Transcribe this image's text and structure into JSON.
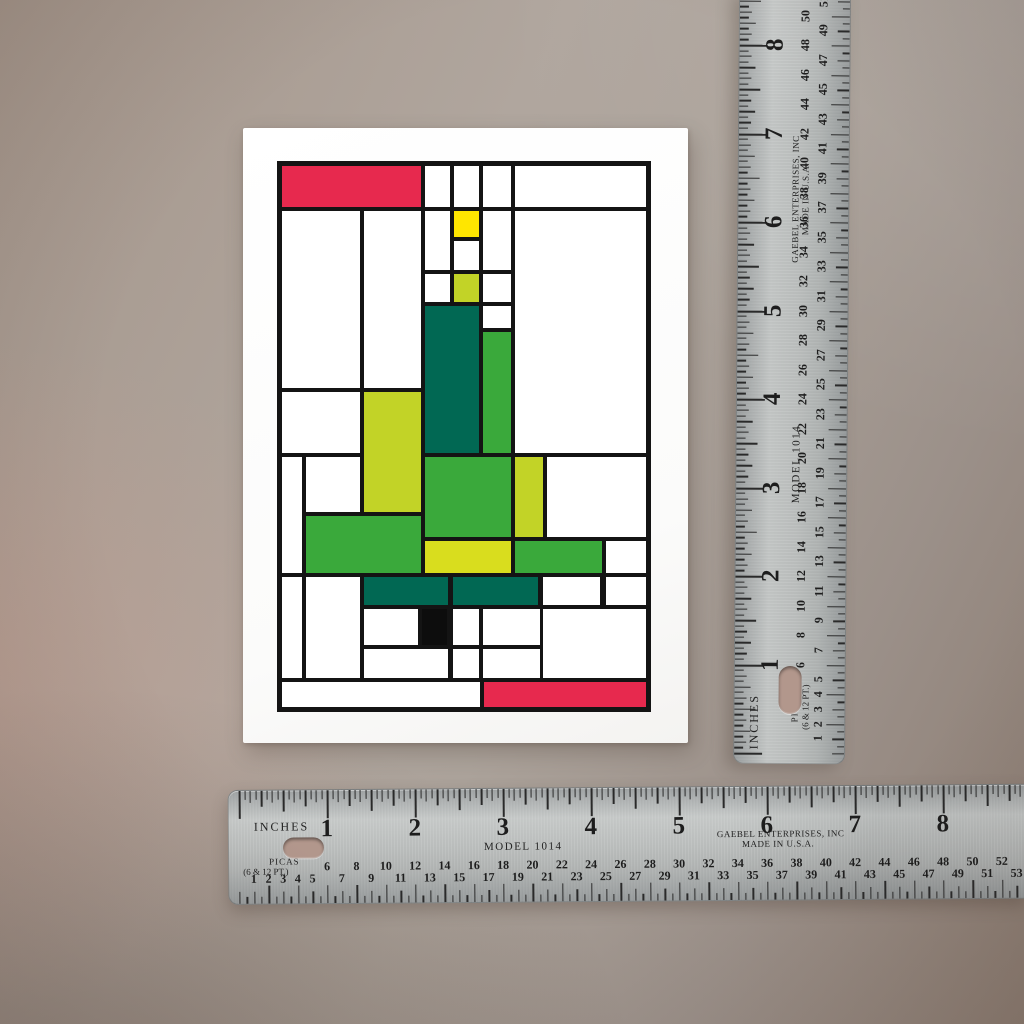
{
  "card": {
    "greeting": {
      "line1": "Merry",
      "line2": "Christmas",
      "color": "#0f0f0f"
    },
    "design": {
      "line_color": "#141414",
      "palette": {
        "red": "#e7294e",
        "yellow": "#ffe600",
        "chartreuse": "#c2d327",
        "yellowgreen": "#d9dd1e",
        "green": "#3aa93b",
        "teal": "#016853",
        "black": "#0d0d0d",
        "white": "#ffffff"
      },
      "cells": [
        {
          "x": 5,
          "y": 5,
          "w": 139,
          "h": 41,
          "c": "red"
        },
        {
          "x": 148,
          "y": 5,
          "w": 25,
          "h": 41,
          "c": "white"
        },
        {
          "x": 177,
          "y": 5,
          "w": 25,
          "h": 41,
          "c": "white"
        },
        {
          "x": 206,
          "y": 5,
          "w": 28,
          "h": 41,
          "c": "white"
        },
        {
          "x": 238,
          "y": 5,
          "w": 131,
          "h": 41,
          "c": "white"
        },
        {
          "x": 5,
          "y": 50,
          "w": 78,
          "h": 177,
          "c": "white"
        },
        {
          "x": 87,
          "y": 50,
          "w": 57,
          "h": 177,
          "c": "white"
        },
        {
          "x": 148,
          "y": 50,
          "w": 25,
          "h": 59,
          "c": "white"
        },
        {
          "x": 177,
          "y": 50,
          "w": 25,
          "h": 26,
          "c": "yellow"
        },
        {
          "x": 177,
          "y": 80,
          "w": 25,
          "h": 29,
          "c": "white"
        },
        {
          "x": 206,
          "y": 50,
          "w": 28,
          "h": 59,
          "c": "white"
        },
        {
          "x": 148,
          "y": 113,
          "w": 25,
          "h": 28,
          "c": "white"
        },
        {
          "x": 177,
          "y": 113,
          "w": 25,
          "h": 28,
          "c": "chartreuse"
        },
        {
          "x": 206,
          "y": 113,
          "w": 28,
          "h": 28,
          "c": "white"
        },
        {
          "x": 148,
          "y": 145,
          "w": 54,
          "h": 147,
          "c": "teal"
        },
        {
          "x": 206,
          "y": 145,
          "w": 28,
          "h": 22,
          "c": "white"
        },
        {
          "x": 206,
          "y": 171,
          "w": 28,
          "h": 121,
          "c": "green"
        },
        {
          "x": 238,
          "y": 50,
          "w": 131,
          "h": 242,
          "c": "white"
        },
        {
          "x": 5,
          "y": 231,
          "w": 78,
          "h": 61,
          "c": "white"
        },
        {
          "x": 87,
          "y": 231,
          "w": 57,
          "h": 120,
          "c": "chartreuse"
        },
        {
          "x": 5,
          "y": 296,
          "w": 20,
          "h": 116,
          "c": "white"
        },
        {
          "x": 29,
          "y": 296,
          "w": 54,
          "h": 55,
          "c": "white"
        },
        {
          "x": 29,
          "y": 355,
          "w": 115,
          "h": 57,
          "c": "green"
        },
        {
          "x": 148,
          "y": 296,
          "w": 86,
          "h": 80,
          "c": "green"
        },
        {
          "x": 238,
          "y": 296,
          "w": 28,
          "h": 80,
          "c": "chartreuse"
        },
        {
          "x": 270,
          "y": 296,
          "w": 99,
          "h": 80,
          "c": "white"
        },
        {
          "x": 148,
          "y": 380,
          "w": 86,
          "h": 32,
          "c": "yellowgreen"
        },
        {
          "x": 238,
          "y": 380,
          "w": 87,
          "h": 32,
          "c": "green"
        },
        {
          "x": 329,
          "y": 380,
          "w": 40,
          "h": 32,
          "c": "white"
        },
        {
          "x": 5,
          "y": 416,
          "w": 20,
          "h": 101,
          "c": "white"
        },
        {
          "x": 29,
          "y": 416,
          "w": 54,
          "h": 101,
          "c": "white"
        },
        {
          "x": 87,
          "y": 416,
          "w": 84,
          "h": 28,
          "c": "teal"
        },
        {
          "x": 176,
          "y": 416,
          "w": 85,
          "h": 28,
          "c": "teal"
        },
        {
          "x": 266,
          "y": 416,
          "w": 57,
          "h": 28,
          "c": "white"
        },
        {
          "x": 329,
          "y": 416,
          "w": 40,
          "h": 28,
          "c": "white"
        },
        {
          "x": 87,
          "y": 448,
          "w": 54,
          "h": 36,
          "c": "white"
        },
        {
          "x": 145,
          "y": 448,
          "w": 25,
          "h": 36,
          "c": "black"
        },
        {
          "x": 176,
          "y": 448,
          "w": 26,
          "h": 36,
          "c": "white"
        },
        {
          "x": 206,
          "y": 448,
          "w": 57,
          "h": 36,
          "c": "white"
        },
        {
          "x": 266,
          "y": 448,
          "w": 103,
          "h": 69,
          "c": "white"
        },
        {
          "x": 87,
          "y": 488,
          "w": 84,
          "h": 29,
          "c": "white"
        },
        {
          "x": 176,
          "y": 488,
          "w": 26,
          "h": 29,
          "c": "white"
        },
        {
          "x": 206,
          "y": 488,
          "w": 57,
          "h": 29,
          "c": "white"
        },
        {
          "x": 5,
          "y": 521,
          "w": 198,
          "h": 25,
          "c": "white"
        },
        {
          "x": 207,
          "y": 521,
          "w": 162,
          "h": 25,
          "c": "red"
        }
      ]
    }
  },
  "rulers": {
    "labels": {
      "inches": "INCHES",
      "picas_line1": "PICAS",
      "picas_line2": "(6 & 12 PT.)",
      "model": "MODEL 1014",
      "brand_line1": "GAEBEL ENTERPRISES, INC",
      "brand_line2": "MADE IN U.S.A."
    },
    "horizontal": {
      "zero_px": 10,
      "px_per_inch": 88,
      "inch_numbers": [
        1,
        2,
        3,
        4,
        5,
        6,
        7,
        8
      ],
      "pica_numbers": [
        1,
        2,
        3,
        4,
        5,
        6,
        7,
        8,
        9,
        10,
        11,
        12,
        13,
        14,
        15,
        16,
        17,
        18,
        19,
        20,
        21,
        22,
        23,
        24,
        25,
        26,
        27,
        28,
        29,
        30,
        31,
        32,
        33,
        34,
        35,
        36,
        37,
        38,
        39,
        40,
        41,
        42,
        43,
        44,
        45,
        46,
        47,
        48,
        49,
        50,
        51,
        52,
        53
      ]
    },
    "vertical": {
      "zero_px": 762,
      "px_per_inch": 88.5,
      "inch_numbers": [
        1,
        2,
        3,
        4,
        5,
        6,
        7,
        8
      ],
      "pica_numbers": [
        1,
        2,
        3,
        4,
        5,
        6,
        7,
        8,
        9,
        10,
        11,
        12,
        13,
        14,
        15,
        16,
        17,
        18,
        19,
        20,
        21,
        22,
        23,
        24,
        25,
        26,
        27,
        28,
        29,
        30,
        31,
        32,
        33,
        34,
        35,
        36,
        37,
        38,
        39,
        40,
        41,
        42,
        43,
        44,
        45,
        46,
        47,
        48,
        49,
        50,
        51,
        52
      ]
    }
  }
}
